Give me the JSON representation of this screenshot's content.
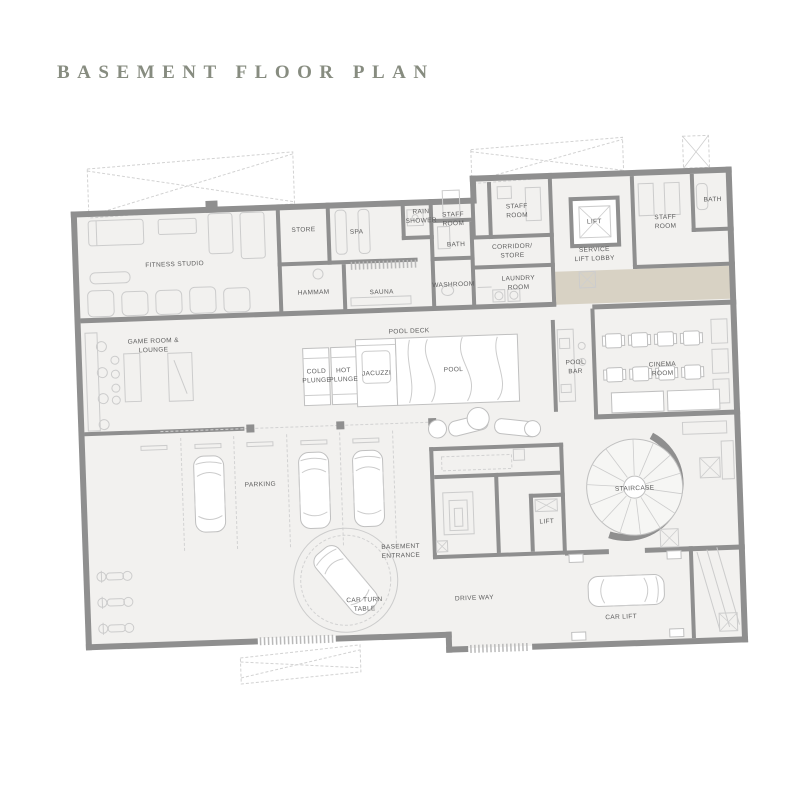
{
  "page": {
    "title": "BASEMENT FLOOR PLAN"
  },
  "plan": {
    "colors": {
      "wall": "#8f8f8f",
      "floor": "#f2f1ef",
      "terrace": "#d8d2c4",
      "title_text": "#878c80",
      "label_text": "#5c5c5c",
      "furniture_line": "#c6c6c6"
    },
    "rooms": {
      "fitness_studio": {
        "lines": [
          "FITNESS STUDIO"
        ]
      },
      "store": {
        "lines": [
          "STORE"
        ]
      },
      "spa": {
        "lines": [
          "SPA"
        ]
      },
      "rain_shower": {
        "lines": [
          "RAIN",
          "SHOWER"
        ]
      },
      "staff_room_a": {
        "lines": [
          "STAFF",
          "ROOM"
        ]
      },
      "staff_room_b": {
        "lines": [
          "STAFF",
          "ROOM"
        ]
      },
      "bath_a": {
        "lines": [
          "BATH"
        ]
      },
      "corridor_store": {
        "lines": [
          "CORRIDOR/",
          "STORE"
        ]
      },
      "washroom": {
        "lines": [
          "WASHROOM"
        ]
      },
      "laundry_room": {
        "lines": [
          "LAUNDRY",
          "ROOM"
        ]
      },
      "lift_service": {
        "lines": [
          "LIFT"
        ]
      },
      "service_lift_lobby": {
        "lines": [
          "SERVICE",
          "LIFT LOBBY"
        ]
      },
      "staff_room_c": {
        "lines": [
          "STAFF",
          "ROOM"
        ]
      },
      "bath_b": {
        "lines": [
          "BATH"
        ]
      },
      "hammam": {
        "lines": [
          "HAMMAM"
        ]
      },
      "sauna": {
        "lines": [
          "SAUNA"
        ]
      },
      "game_room_lounge": {
        "lines": [
          "GAME ROOM &",
          "LOUNGE"
        ]
      },
      "pool_deck": {
        "lines": [
          "POOL DECK"
        ]
      },
      "cold_plunge": {
        "lines": [
          "COLD",
          "PLUNGE"
        ]
      },
      "hot_plunge": {
        "lines": [
          "HOT",
          "PLUNGE"
        ]
      },
      "jacuzzi": {
        "lines": [
          "JACUZZI"
        ]
      },
      "pool": {
        "lines": [
          "POOL"
        ]
      },
      "pool_bar": {
        "lines": [
          "POOL",
          "BAR"
        ]
      },
      "cinema_room": {
        "lines": [
          "CINEMA",
          "ROOM"
        ]
      },
      "parking": {
        "lines": [
          "PARKING"
        ]
      },
      "basement_entrance": {
        "lines": [
          "BASEMENT",
          "ENTRANCE"
        ]
      },
      "lift_lower": {
        "lines": [
          "LIFT"
        ]
      },
      "staircase": {
        "lines": [
          "STAIRCASE"
        ]
      },
      "car_turn_table": {
        "lines": [
          "CAR TURN",
          "TABLE"
        ]
      },
      "drive_way": {
        "lines": [
          "DRIVE WAY"
        ]
      },
      "car_lift": {
        "lines": [
          "CAR LIFT"
        ]
      }
    }
  }
}
